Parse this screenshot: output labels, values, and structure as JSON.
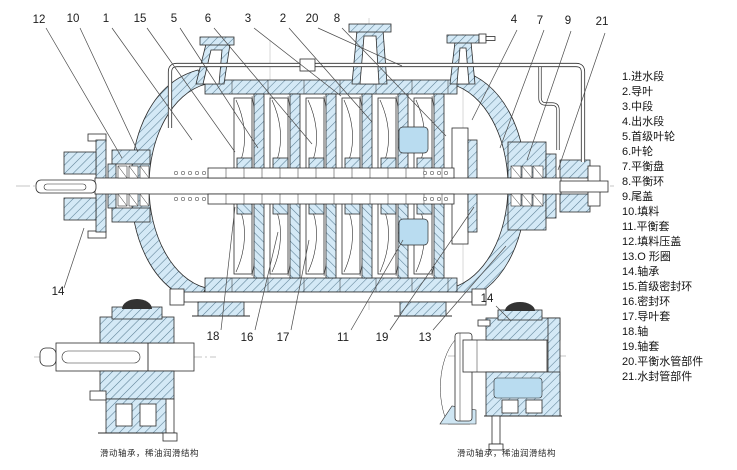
{
  "figure": {
    "kind": "pump-sectional-drawing",
    "colors": {
      "section_fill": "#d4e9f6",
      "hatch_line": "#5b7f94",
      "chamber_fill": "#b9dcf0",
      "outline": "#2b2b2b",
      "dark_cap": "#333333",
      "text": "#141414"
    }
  },
  "legend": {
    "items": [
      "1.进水段",
      "2.导叶",
      "3.中段",
      "4.出水段",
      "5.首级叶轮",
      "6.叶轮",
      "7.平衡盘",
      "8.平衡环",
      "9.尾盖",
      "10.填料",
      "11.平衡套",
      "12.填料压盖",
      "13.O 形圈",
      "14.轴承",
      "15.首级密封环",
      "16.密封环",
      "17.导叶套",
      "18.轴",
      "19.轴套",
      "20.平衡水管部件",
      "21.水封管部件"
    ]
  },
  "callouts": {
    "labels": [
      "12",
      "10",
      "1",
      "15",
      "5",
      "6",
      "3",
      "2",
      "20",
      "8",
      "4",
      "7",
      "9",
      "21",
      "14",
      "18",
      "16",
      "17",
      "11",
      "19",
      "13",
      "14"
    ]
  },
  "captions": {
    "left_inset": "滑动轴承，稀油润滑结构",
    "right_inset": "滑动轴承，稀油润滑结构"
  }
}
